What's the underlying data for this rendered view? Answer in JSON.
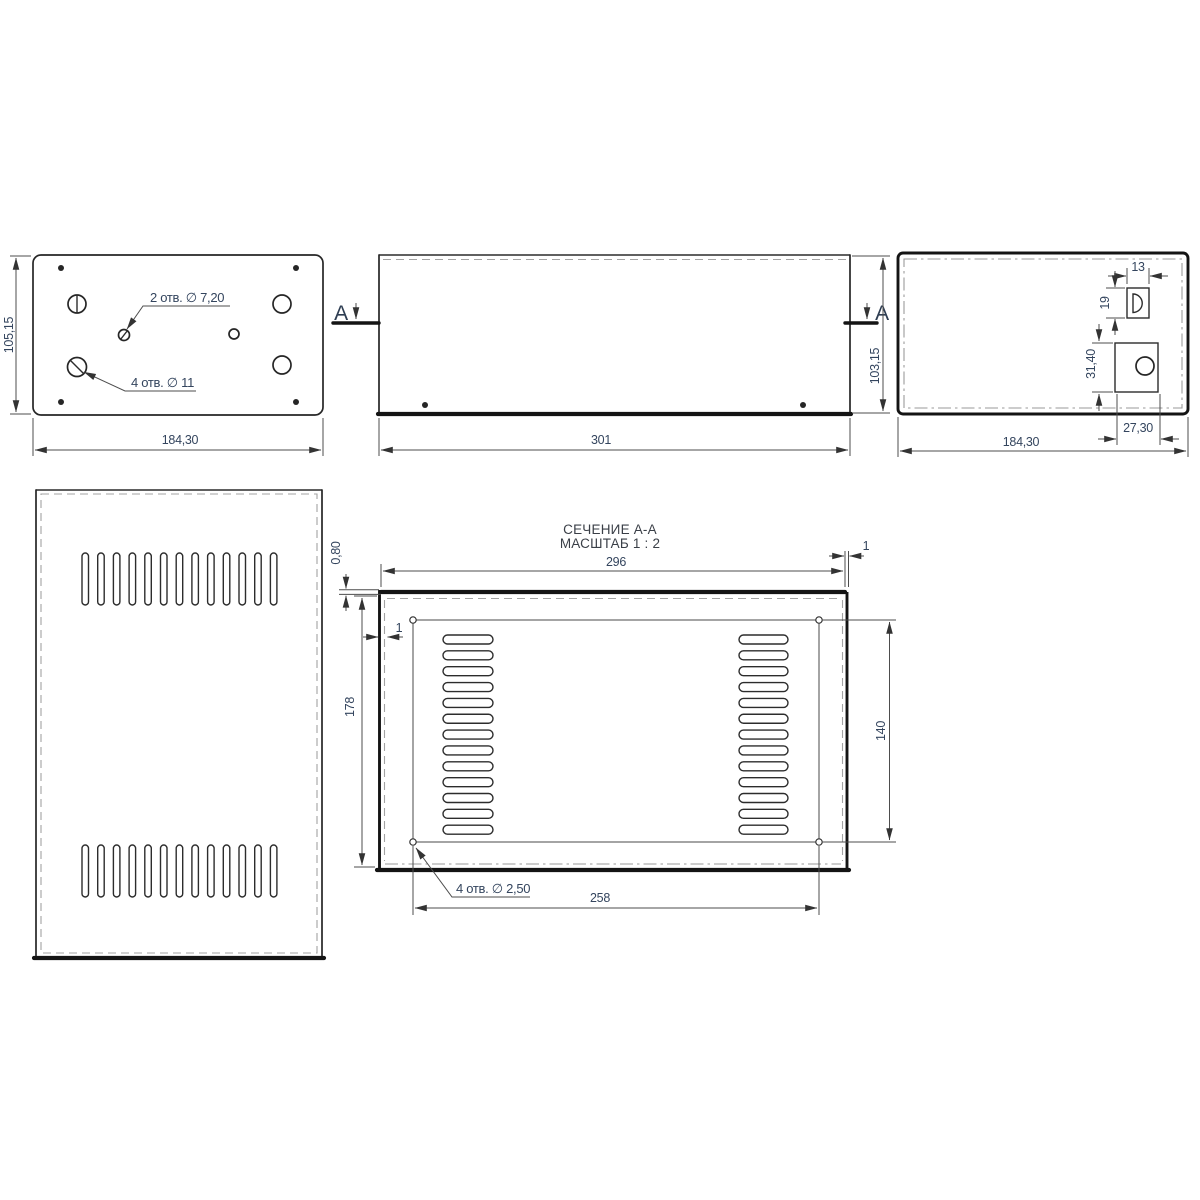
{
  "top_view": {
    "height_dim": "105,15",
    "width_dim": "184,30",
    "holes_small_callout": "2 отв. ∅ 7,20",
    "holes_large_callout": "4 отв. ∅ 11"
  },
  "front_view": {
    "length_dim": "301",
    "height_dim": "103,15",
    "marker_left": "A",
    "marker_right": "A"
  },
  "end_view": {
    "width_dim": "184,30",
    "notch_width_dim": "13",
    "notch_height_dim": "19",
    "cutout_height_dim": "31,40",
    "cutout_width_dim": "27,30"
  },
  "bottom_panel": {
    "vent_rows": 2,
    "slots_per_row": 13
  },
  "section_view": {
    "title": "СЕЧЕНИЕ А-А",
    "scale": "МАСШТАБ 1 : 2",
    "width_dim": "296",
    "gap_right_dim": "1",
    "gap_left_dim": "1",
    "thickness_dim": "0,80",
    "height_dim": "178",
    "holes_height_dim": "140",
    "holes_width_dim": "258",
    "holes_callout": "4 отв. ∅ 2,50",
    "slot_columns": 2,
    "slots_per_column": 13
  }
}
